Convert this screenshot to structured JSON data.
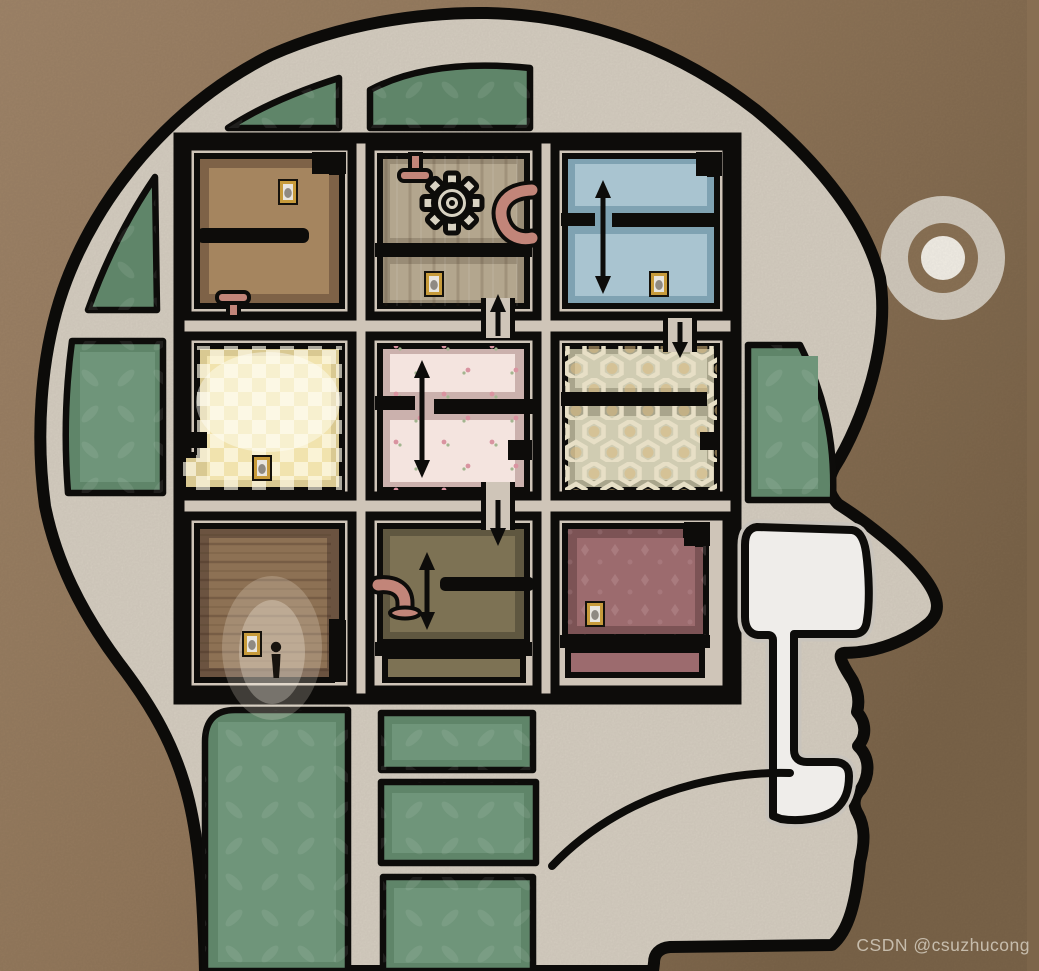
{
  "watermark": {
    "text": "CSDN @csuzhucong"
  },
  "palette": {
    "background_light": "#a1866a",
    "background_mid": "#94795c",
    "background_dark": "#7c654a",
    "head_fill": "#d8d0c3",
    "outline": "#0d0c0a",
    "wall_beige": "#cfc5b8",
    "cavity_white": "#efedea",
    "cavity_rim": "#c9c4bc",
    "green_panel": "#5f8569",
    "green_panel_inner": "#6f957a",
    "room1_edge": "#7e6247",
    "room1_floor": "#a5855f",
    "room2_edge": "#998c76",
    "room2_floor": "#b3a68e",
    "room3_edge": "#7fa2b2",
    "room3_floor": "#a9c4d0",
    "room4_edge": "#d9c992",
    "room4_floor": "#f1e3ae",
    "room5_edge": "#cbb1ad",
    "room5_floor": "#f4e4df",
    "room6_edge": "#a9a58c",
    "room6_floor": "#d0ccb2",
    "room7_edge": "#6b5340",
    "room7_floor": "#8d7154",
    "room8_edge": "#5f5740",
    "room8_floor": "#7d7254",
    "room9_edge": "#7c5355",
    "room9_floor": "#9c6b6e",
    "pipe_pink": "#c28579",
    "frame_gold": "#c79b3b",
    "frame_paper": "#e9e6df",
    "gear_fill": "#d8d2c2",
    "ear_ring": "#d3cbbe",
    "ear_mid": "#8c7356",
    "ear_core": "#f5f1e8",
    "watermark_color": "#d8d1c3"
  },
  "scene": {
    "description": "cutaway illustration of a human head in right-facing profile containing a 3x3 grid of rooms",
    "ear_button": {
      "shape": "concentric-circles"
    },
    "rooms": [
      {
        "id": "top-left",
        "wallpaper": "plain brown",
        "features": [
          "picture-frame",
          "plunger-pipe",
          "wall-partition"
        ]
      },
      {
        "id": "top-center",
        "wallpaper": "wood planks",
        "features": [
          "gear",
          "plunger-pipe",
          "curved-pipe",
          "picture-frame",
          "doorway-up-arrow"
        ]
      },
      {
        "id": "top-right",
        "wallpaper": "blue",
        "features": [
          "slide-wall-arrow",
          "picture-frame"
        ]
      },
      {
        "id": "middle-left",
        "wallpaper": "yellow checkered",
        "features": [
          "picture-frame",
          "glow"
        ]
      },
      {
        "id": "middle-center",
        "wallpaper": "pink floral",
        "features": [
          "slide-wall-arrow",
          "doorway-down-arrow"
        ]
      },
      {
        "id": "middle-right",
        "wallpaper": "hexagon tile",
        "features": [
          "doorway-down-arrow"
        ]
      },
      {
        "id": "bottom-left",
        "wallpaper": "dark wood planks",
        "features": [
          "player-character",
          "picture-frame",
          "glow"
        ]
      },
      {
        "id": "bottom-center",
        "wallpaper": "olive",
        "features": [
          "elbow-pipe",
          "slide-wall-arrow",
          "doorway-down-arrow"
        ]
      },
      {
        "id": "bottom-right",
        "wallpaper": "maroon damask",
        "features": [
          "picture-frame"
        ]
      }
    ]
  }
}
